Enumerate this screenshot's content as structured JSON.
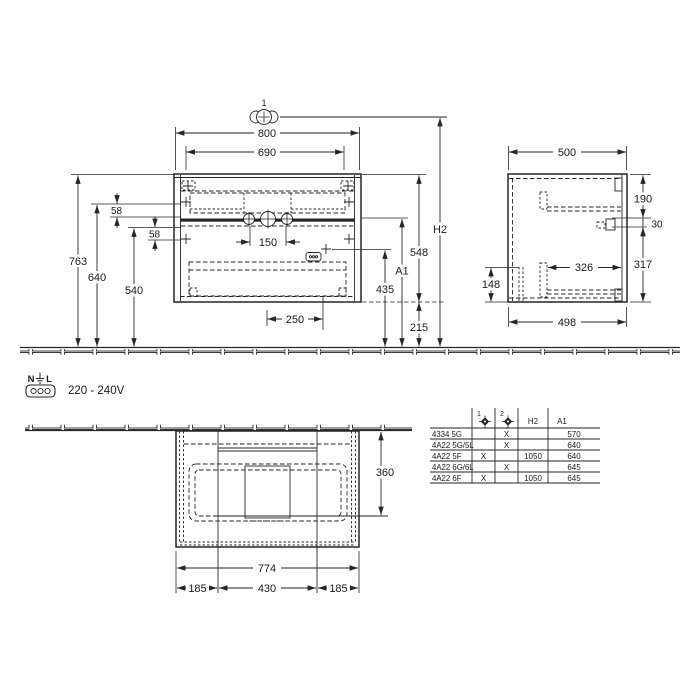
{
  "colors": {
    "line": "#262626",
    "background": "#ffffff"
  },
  "front_view": {
    "callout": "1",
    "w800": "800",
    "w690": "690",
    "h763": "763",
    "h640": "640",
    "h540": "540",
    "s58_upper": "58",
    "s58_lower": "58",
    "tap_spacing_150": "150",
    "o250": "250",
    "h435": "435",
    "h548": "548",
    "h215": "215",
    "h2_label": "H2",
    "a1_label": "A1"
  },
  "side_view": {
    "d500": "500",
    "h190": "190",
    "h30": "30",
    "h317": "317",
    "h148": "148",
    "d326": "326",
    "d498": "498"
  },
  "plan_view": {
    "d360": "360",
    "w774": "774",
    "w185_left": "185",
    "w430": "430",
    "w185_right": "185"
  },
  "electrical": {
    "n_label": "N",
    "l_label": "L",
    "voltage": "220 - 240V"
  },
  "variant_table": {
    "col1_label": "1",
    "col2_label": "2",
    "h2_header": "H2",
    "a1_header": "A1",
    "rows": [
      {
        "model": "4334 5G",
        "pos1": "",
        "pos2": "X",
        "h2": "",
        "a1": "570"
      },
      {
        "model": "4A22 5G/5L",
        "pos1": "",
        "pos2": "X",
        "h2": "",
        "a1": "640"
      },
      {
        "model": "4A22 5F",
        "pos1": "X",
        "pos2": "",
        "h2": "1050",
        "a1": "640"
      },
      {
        "model": "4A22 6G/6L",
        "pos1": "",
        "pos2": "X",
        "h2": "",
        "a1": "645"
      },
      {
        "model": "4A22 6F",
        "pos1": "X",
        "pos2": "",
        "h2": "1050",
        "a1": "645"
      }
    ]
  },
  "icons": {
    "tap_holes": "three overlapping circles with crosshair",
    "earth": "earth ground symbol",
    "socket": "three-hole socket",
    "drill_marker": "diamond crosshair"
  }
}
